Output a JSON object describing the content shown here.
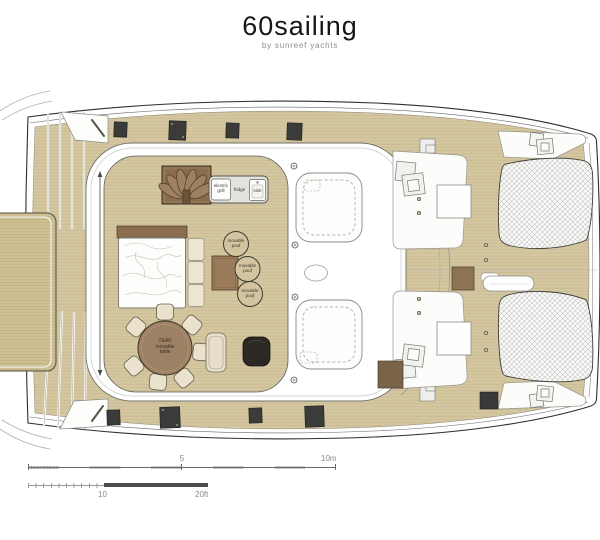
{
  "header": {
    "title": "60sailing",
    "subtitle": "by sunreef yachts"
  },
  "plan": {
    "galley": {
      "grill": "electric grill",
      "fridge": "fridge",
      "sink": "sink"
    },
    "pouf_label": "movable pouf",
    "table_label": "TEAK movable table"
  },
  "scale_bar": {
    "meters": {
      "mid": "5",
      "end": "10m"
    },
    "feet": {
      "mid": "10",
      "end": "20ft"
    }
  },
  "colors": {
    "deck_wood": "#d4c7a0",
    "dark_wood": "#8a6d4e",
    "table_wood": "#9c8164",
    "hatch_dark": "#3b3b39",
    "upholstery": "#ece5d1",
    "mesh_line": "#88888a"
  }
}
